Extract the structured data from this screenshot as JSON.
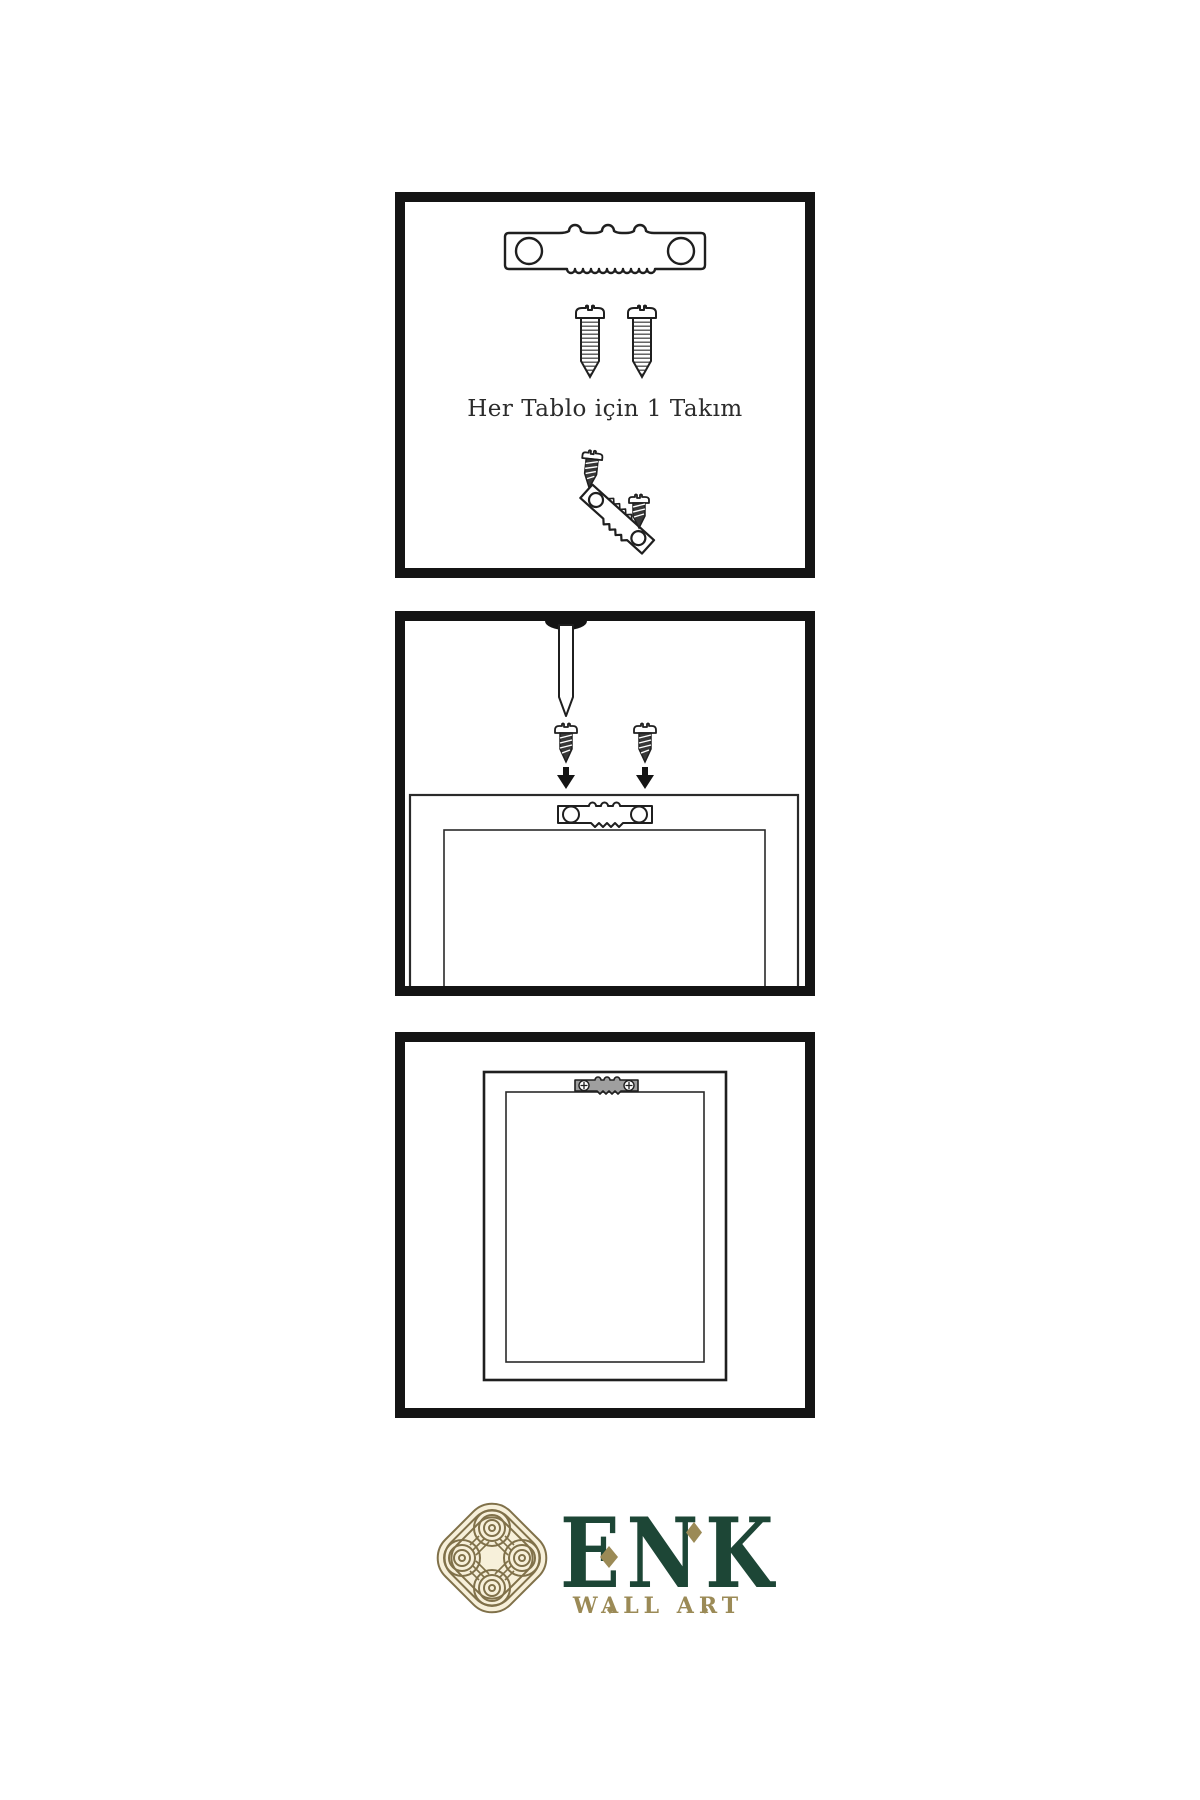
{
  "caption": {
    "panel1": "Her Tablo için 1 Takım"
  },
  "brand": {
    "name": "ENK",
    "subtitle": "WALL ART"
  },
  "colors": {
    "page_bg": "#ffffff",
    "panel_border": "#141414",
    "ink": "#1f1f1f",
    "screw_dark": "#383838",
    "hanger_gray": "#9f9f9f",
    "brand_green": "#1d4636",
    "brand_gold": "#9b8a56",
    "emblem_line": "#80714a",
    "emblem_bg": "#f7f0da"
  },
  "panels": [
    {
      "step": 1,
      "icons": [
        "sawtooth-hanger-icon",
        "screw-icon",
        "screw-icon",
        "mounting-screw-icon",
        "tilted-hanger-icon",
        "mounting-screw-icon"
      ]
    },
    {
      "step": 2,
      "icons": [
        "wall-hole-icon",
        "nail-icon",
        "screw-icon",
        "down-arrow-icon",
        "screw-icon",
        "down-arrow-icon",
        "frame-back-icon",
        "sawtooth-hanger-icon"
      ]
    },
    {
      "step": 3,
      "icons": [
        "frame-front-icon",
        "installed-hanger-icon"
      ]
    }
  ],
  "footer_icons": [
    "knot-emblem-icon",
    "diamond-icon",
    "diamond-icon"
  ]
}
